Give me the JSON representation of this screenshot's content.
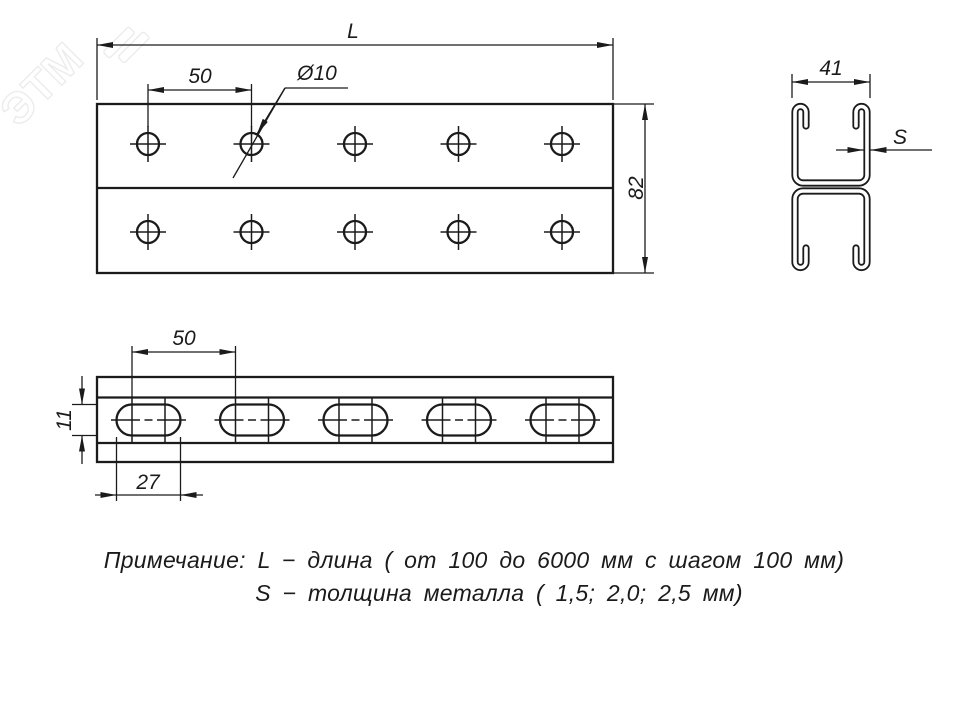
{
  "drawing": {
    "watermark": "ЭТМ",
    "front_view": {
      "length_label": "L",
      "hole_pitch_label": "50",
      "hole_diameter_label": "Ø10",
      "height_label": "82"
    },
    "section_view": {
      "width_label": "41",
      "thickness_label": "S"
    },
    "side_view": {
      "slot_pitch_label": "50",
      "slot_width_label": "11",
      "slot_length_label": "27"
    },
    "notes": {
      "line1": "Примечание: L − длина ( от 100 до 6000 мм с шагом 100 мм)",
      "line2": "S − толщина металла ( 1,5; 2,0; 2,5 мм)"
    }
  }
}
